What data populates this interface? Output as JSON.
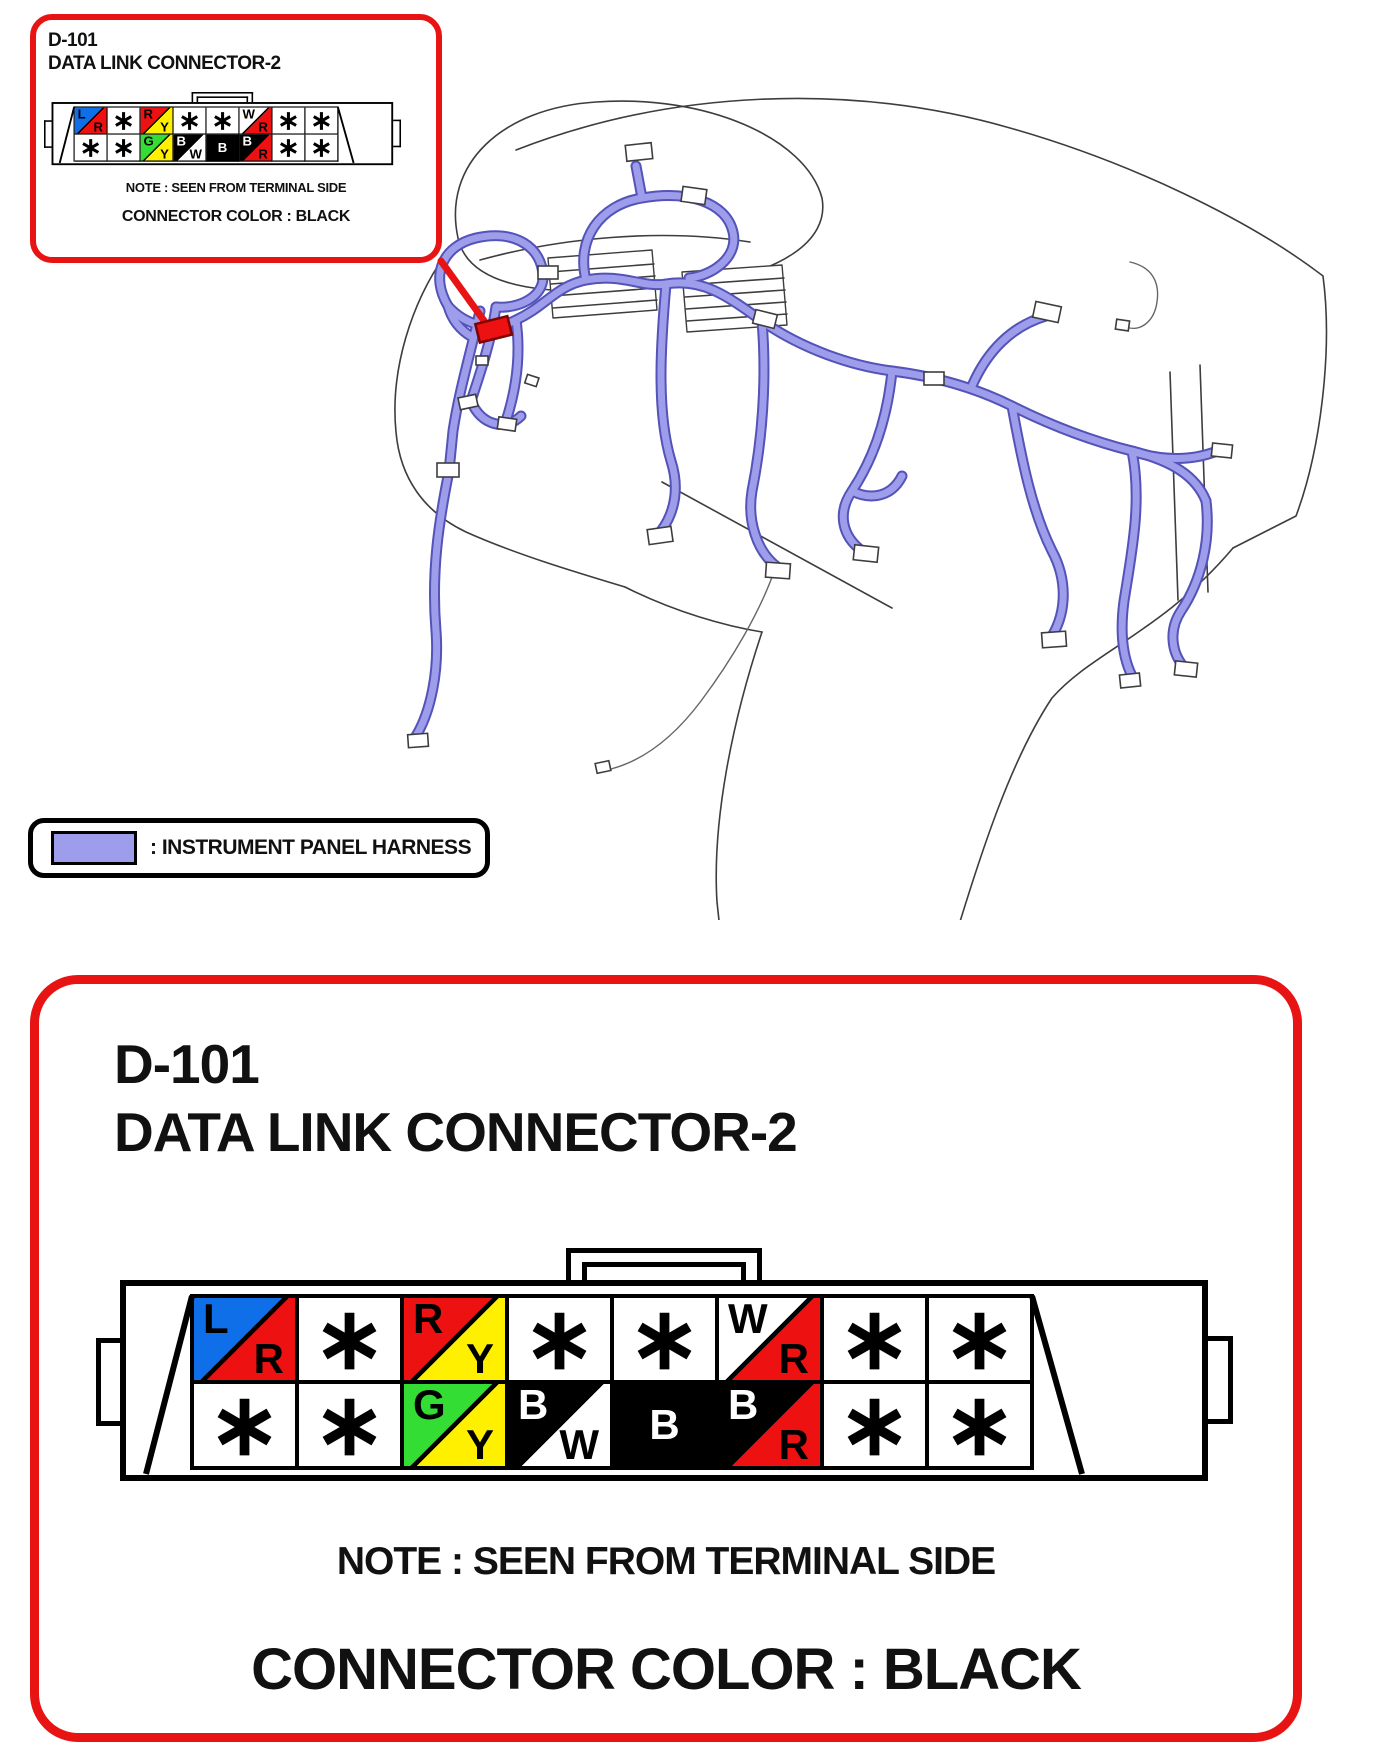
{
  "palette": {
    "accent_red": "#e81414",
    "marker_red": "#ee1111",
    "harness_fill": "#9d9deb",
    "harness_outline": "#5353b8"
  },
  "wire_colors": {
    "blue": "#0f6fe8",
    "red": "#ee1111",
    "yellow": "#fff000",
    "green": "#33dd33",
    "black": "#000000",
    "white": "#ffffff"
  },
  "connector_info": {
    "id": "D-101",
    "name": "DATA LINK CONNECTOR-2",
    "note": "NOTE : SEEN FROM TERMINAL SIDE",
    "color_label": "CONNECTOR COLOR : BLACK"
  },
  "legend": {
    "label": ": INSTRUMENT PANEL HARNESS"
  },
  "pinout": {
    "star": "∗",
    "rows": [
      [
        {
          "t": "split",
          "c1": "blue",
          "l1": "L",
          "c2": "red",
          "l2": "R"
        },
        {
          "t": "star"
        },
        {
          "t": "split",
          "c1": "red",
          "l1": "R",
          "c2": "yellow",
          "l2": "Y"
        },
        {
          "t": "star"
        },
        {
          "t": "star"
        },
        {
          "t": "split",
          "c1": "white",
          "l1": "W",
          "c2": "red",
          "l2": "R"
        },
        {
          "t": "star"
        },
        {
          "t": "star"
        }
      ],
      [
        {
          "t": "star"
        },
        {
          "t": "star"
        },
        {
          "t": "split",
          "c1": "green",
          "l1": "G",
          "c2": "yellow",
          "l2": "Y"
        },
        {
          "t": "split",
          "c1": "black",
          "l1": "B",
          "c2": "white",
          "l2": "W"
        },
        {
          "t": "solid",
          "c1": "black",
          "l1": "B"
        },
        {
          "t": "split",
          "c1": "black",
          "l1": "B",
          "c2": "red",
          "l2": "R"
        },
        {
          "t": "star"
        },
        {
          "t": "star"
        }
      ]
    ]
  }
}
